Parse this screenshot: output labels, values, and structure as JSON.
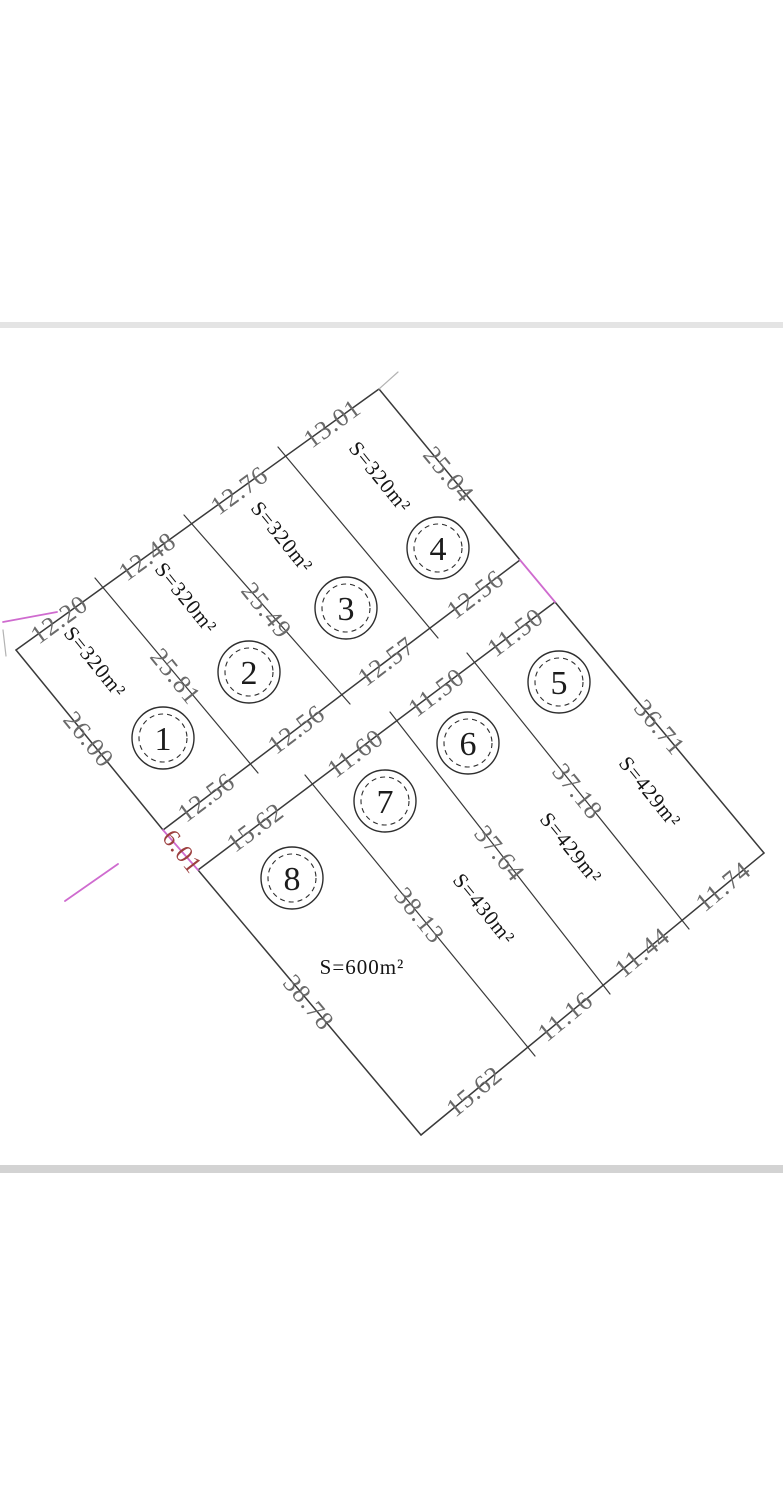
{
  "title": "Land subdivision cadastral plan",
  "plots": [
    {
      "number": "1",
      "area": "S=320m²"
    },
    {
      "number": "2",
      "area": "S=320m²"
    },
    {
      "number": "3",
      "area": "S=320m²"
    },
    {
      "number": "4",
      "area": "S=320m²"
    },
    {
      "number": "5",
      "area": "S=429m²"
    },
    {
      "number": "6",
      "area": "S=429m²"
    },
    {
      "number": "7",
      "area": "S=430m²"
    },
    {
      "number": "8",
      "area": "S=600m²"
    }
  ],
  "dims": {
    "nw": [
      "13.01",
      "12.76",
      "12.48",
      "12.20"
    ],
    "ne4": "25.04",
    "ne5": "36.71",
    "se": [
      "11.74",
      "11.44",
      "11.16",
      "15.62"
    ],
    "sw8": "38.78",
    "w1": "26.00",
    "road_north": [
      "12.56",
      "12.56",
      "12.57",
      "12.56"
    ],
    "road_south": [
      "15.62",
      "11.60",
      "11.50",
      "11.50"
    ],
    "road_width": "6.01",
    "b12": "25.81",
    "b23": "25.49",
    "b56": "37.18",
    "b67": "37.64",
    "b78": "38.13"
  },
  "colors": {
    "line": "#3a3a3a",
    "dimension_text": "#6a6a6a",
    "area_text": "#141414",
    "magenta": "#cf6bcf",
    "red_label": "#9c3f3f",
    "divider_top": "#e4e4e4",
    "divider_bottom": "#d3d3d3"
  }
}
